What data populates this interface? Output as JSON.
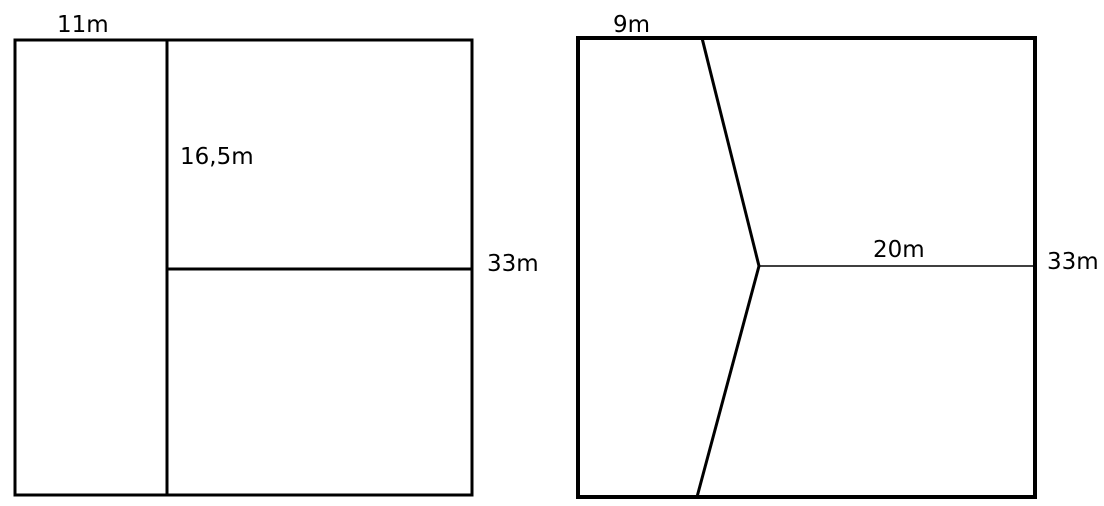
{
  "page": {
    "background_color": "#ffffff",
    "line_color": "#000000"
  },
  "left_figure": {
    "top_label": "11m",
    "inner_label": "16,5m",
    "right_label": "33m"
  },
  "right_figure": {
    "top_label": "9m",
    "inner_label": "20m",
    "right_label": "33m"
  }
}
